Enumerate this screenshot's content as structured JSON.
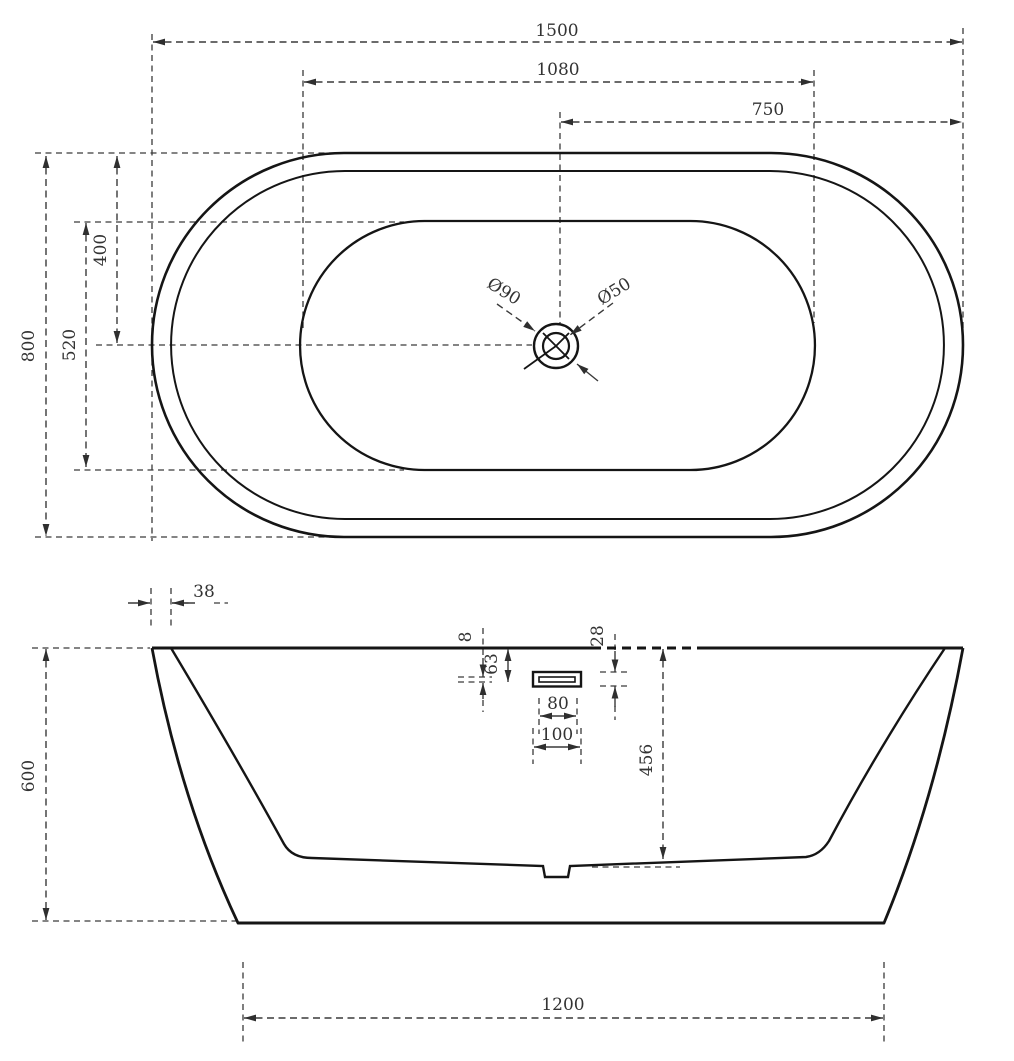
{
  "drawing": {
    "type": "bathtub-dimension-drawing",
    "background": "#ffffff",
    "line_color": "#151515",
    "dim_color": "#3a3a3a",
    "top_view": {
      "overall_length": "1500",
      "basin_length": "1080",
      "drain_offset_from_right": "750",
      "overall_width": "800",
      "basin_width": "520",
      "centerline_offset": "400",
      "drain_outer_diameter": "Ø90",
      "drain_inner_diameter": "Ø50"
    },
    "side_view": {
      "rim_width": "38",
      "overall_height": "600",
      "overflow_slot_height": "8",
      "overflow_top_offset": "63",
      "overflow_cutout_height": "28",
      "overflow_slot_width": "80",
      "overflow_cutout_width": "100",
      "overflow_to_bottom": "456",
      "base_length": "1200"
    }
  }
}
